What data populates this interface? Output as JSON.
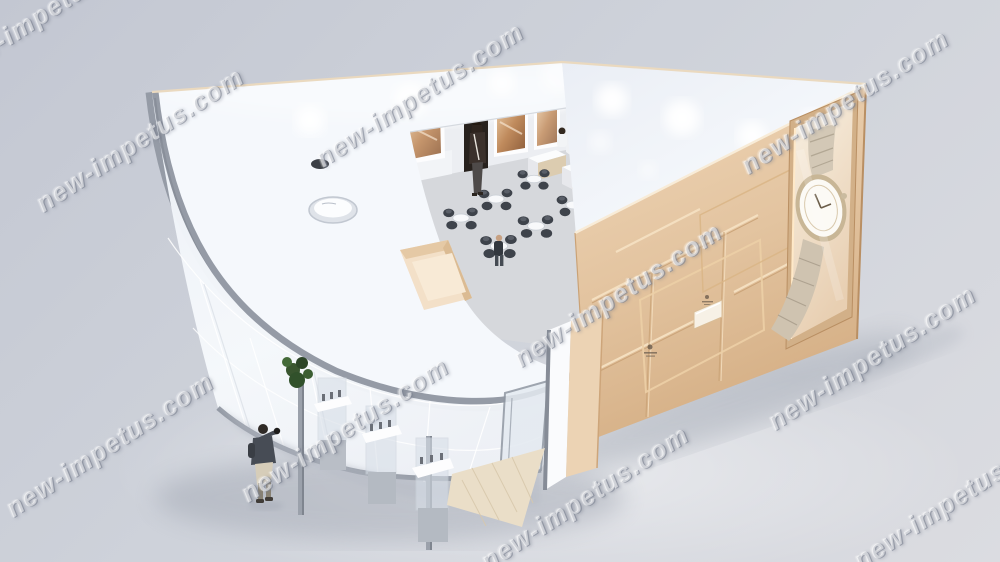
{
  "watermark": {
    "text": "new-impetus.com",
    "color": "#ffffff",
    "opacity": 0.52
  },
  "palette": {
    "background_top": "#c3c7d2",
    "background_bottom": "#dbdce1",
    "roof_white": "#f5f8fc",
    "canopy_band": "#959ba6",
    "wall_beige": "#e6c9a8",
    "wall_beige_deep": "#d6b28a",
    "gold_trim": "#eccfa6",
    "wood_floor": "#eadec8",
    "poster_cream": "#f5ecdd",
    "chair": "#3e434b",
    "glass_wall": "#eff3f8",
    "floor_inside": "#d6d8dc",
    "shadow": "#9ba1ad"
  }
}
